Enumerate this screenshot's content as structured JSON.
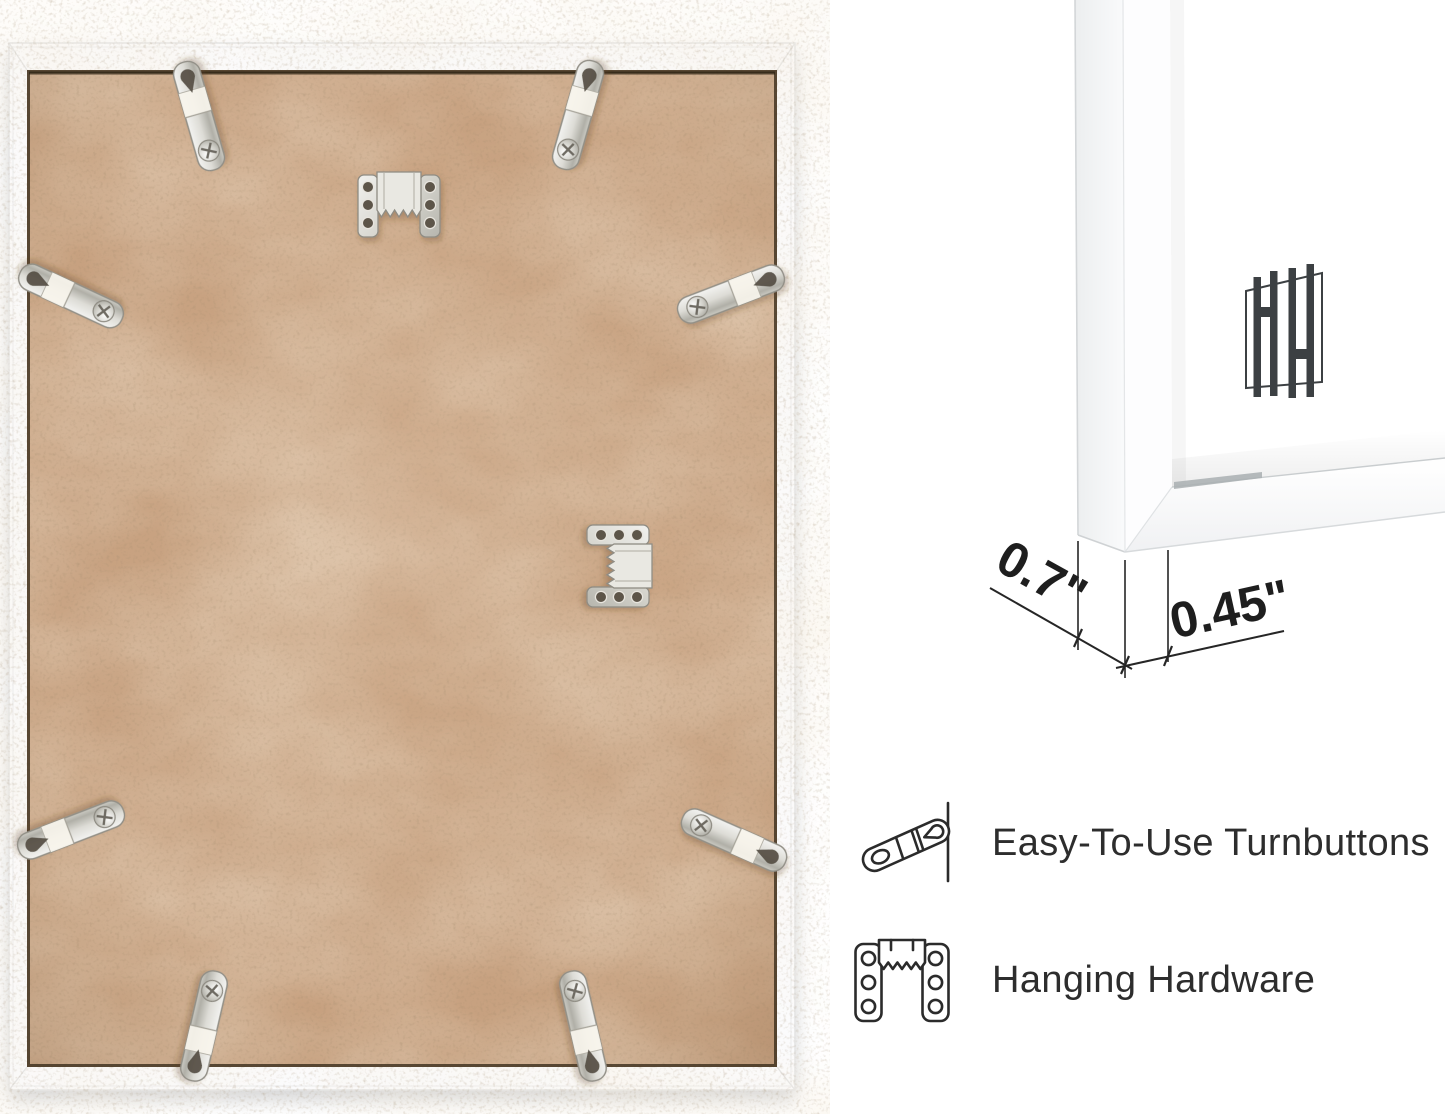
{
  "page": {
    "background": "#ffffff"
  },
  "back_photo": {
    "frame_color": "#fbfbfc",
    "board_color": "#c7a180",
    "turnbutton_count": 8,
    "sawtooth_hanger_count": 2
  },
  "corner_detail": {
    "depth_label": "0.7\"",
    "face_label": "0.45\"",
    "logo_monogram": "HH"
  },
  "features": [
    {
      "icon": "turnbutton-icon",
      "label": "Easy-To-Use Turnbuttons"
    },
    {
      "icon": "hanging-hardware-icon",
      "label": "Hanging Hardware"
    }
  ],
  "text_color": "#2d2d2d",
  "line_color": "#262626",
  "metal_color": "#d6d6d0"
}
